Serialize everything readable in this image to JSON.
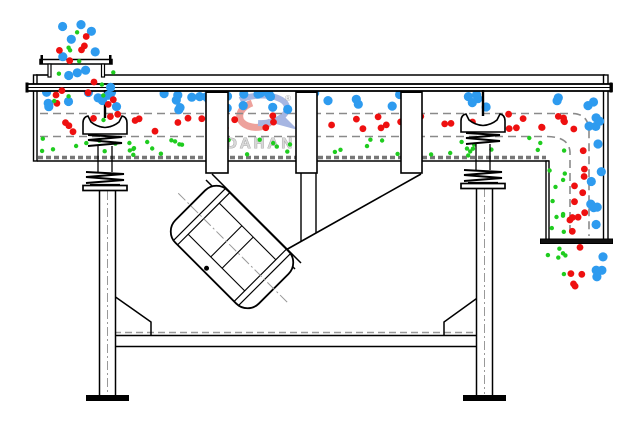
{
  "watermark": {
    "text": "DAHAN",
    "registered": "®"
  },
  "colors": {
    "coarse_particle": "#2E9BEF",
    "medium_particle": "#EE1010",
    "fine_particle": "#1FCC1F",
    "outline": "#000000",
    "hidden_line": "#8A8A8A",
    "mesh_line": "#777777",
    "watermark_text": "#D8D8D8",
    "watermark_outline": "#9A9A9A",
    "logo_red": "#D93025",
    "logo_blue": "#3B5FC0"
  },
  "particles": {
    "regions": [
      {
        "name": "feed-above-coarse",
        "color": "coarse_particle",
        "x": 55,
        "y": 24,
        "w": 44,
        "h": 38,
        "count": 6,
        "r": 4.6,
        "seed": 11,
        "z": "above"
      },
      {
        "name": "feed-above-medium",
        "color": "medium_particle",
        "x": 57,
        "y": 26,
        "w": 42,
        "h": 36,
        "count": 5,
        "r": 3.4,
        "seed": 22,
        "z": "above"
      },
      {
        "name": "feed-above-fine",
        "color": "fine_particle",
        "x": 60,
        "y": 30,
        "w": 40,
        "h": 34,
        "count": 4,
        "r": 2.2,
        "seed": 33,
        "z": "above"
      },
      {
        "name": "feed-below-coarse",
        "color": "coarse_particle",
        "x": 48,
        "y": 62,
        "w": 68,
        "h": 48,
        "count": 8,
        "r": 4.6,
        "seed": 44,
        "z": "above"
      },
      {
        "name": "feed-below-medium",
        "color": "medium_particle",
        "x": 48,
        "y": 66,
        "w": 68,
        "h": 58,
        "count": 9,
        "r": 3.4,
        "seed": 55,
        "z": "above"
      },
      {
        "name": "feed-below-fine",
        "color": "fine_particle",
        "x": 52,
        "y": 72,
        "w": 64,
        "h": 62,
        "count": 7,
        "r": 2.2,
        "seed": 66,
        "z": "above"
      },
      {
        "name": "top-layer-coarse",
        "color": "coarse_particle",
        "x": 42,
        "y": 92,
        "w": 556,
        "h": 18,
        "count": 46,
        "r": 4.6,
        "seed": 77,
        "z": "below"
      },
      {
        "name": "middle-layer-medium",
        "color": "medium_particle",
        "x": 42,
        "y": 114,
        "w": 526,
        "h": 20,
        "count": 44,
        "r": 3.4,
        "seed": 88,
        "z": "below"
      },
      {
        "name": "bottom-layer-fine",
        "color": "fine_particle",
        "x": 42,
        "y": 138,
        "w": 499,
        "h": 18,
        "count": 52,
        "r": 2.2,
        "seed": 99,
        "z": "below"
      },
      {
        "name": "discharge-curve-coarse",
        "color": "coarse_particle",
        "x": 588,
        "y": 96,
        "w": 15,
        "h": 138,
        "count": 13,
        "r": 4.6,
        "seed": 111,
        "z": "above"
      },
      {
        "name": "discharge-curve-medium",
        "color": "medium_particle",
        "x": 569,
        "y": 120,
        "w": 16,
        "h": 113,
        "count": 12,
        "r": 3.4,
        "seed": 122,
        "z": "above"
      },
      {
        "name": "discharge-curve-fine",
        "color": "fine_particle",
        "x": 549,
        "y": 141,
        "w": 16,
        "h": 92,
        "count": 11,
        "r": 2.2,
        "seed": 133,
        "z": "above"
      },
      {
        "name": "outfall-coarse",
        "color": "coarse_particle",
        "x": 588,
        "y": 247,
        "w": 15,
        "h": 32,
        "count": 4,
        "r": 4.6,
        "seed": 144,
        "z": "above"
      },
      {
        "name": "outfall-medium",
        "color": "medium_particle",
        "x": 567,
        "y": 246,
        "w": 18,
        "h": 42,
        "count": 5,
        "r": 3.4,
        "seed": 155,
        "z": "above"
      },
      {
        "name": "outfall-fine",
        "color": "fine_particle",
        "x": 547,
        "y": 247,
        "w": 19,
        "h": 46,
        "count": 6,
        "r": 2.2,
        "seed": 166,
        "z": "above"
      }
    ]
  }
}
